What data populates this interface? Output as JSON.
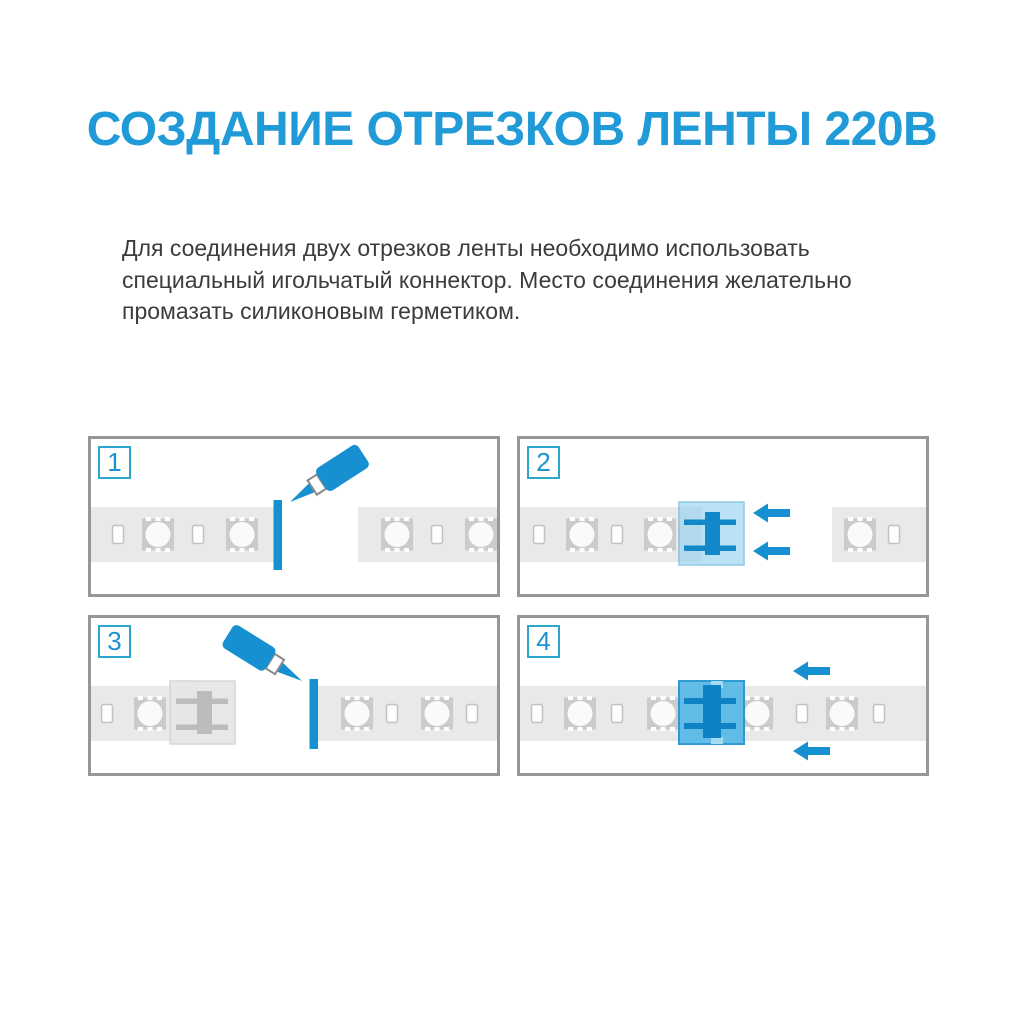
{
  "title": {
    "text": "СОЗДАНИЕ ОТРЕЗКОВ ЛЕНТЫ 220В"
  },
  "intro": {
    "lines": [
      "Для соединения двух отрезков ленты необходимо использовать",
      "специальный игольчатый коннектор. Место соединения желательно",
      "промазать силиконовым герметиком."
    ]
  },
  "steps": [
    {
      "number": "1",
      "icons": [
        "glue-tube-icon",
        "cut-end-seal"
      ]
    },
    {
      "number": "2",
      "icons": [
        "needle-connector",
        "arrow-left-icon"
      ]
    },
    {
      "number": "3",
      "icons": [
        "attached-connector",
        "glue-tube-icon",
        "cut-end-seal"
      ]
    },
    {
      "number": "4",
      "icons": [
        "needle-connector",
        "arrow-left-icon"
      ]
    }
  ],
  "colors": {
    "title_blue": "#219bd8",
    "accent_blue": "#1690d0",
    "badge_border": "#2ba6cc",
    "badge_number": "#1b92d1",
    "panel_border": "#969696",
    "strip_gray": "#e9e9e9",
    "chip_gray": "#cbcbcb",
    "connector_blue_fill": "#55b9e6",
    "connector_gray_fill": "#e6e6e6",
    "text_dark": "#3c3c3c"
  }
}
